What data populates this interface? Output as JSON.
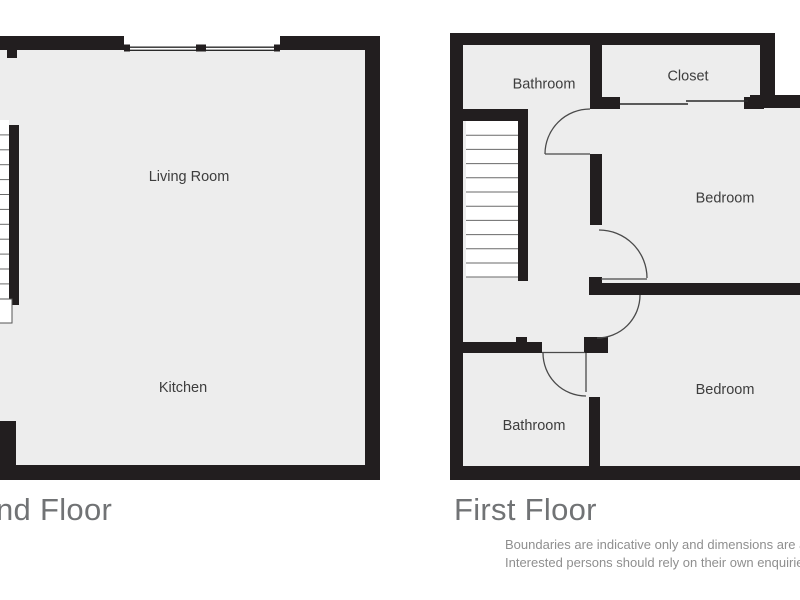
{
  "plans": [
    {
      "title": "nd Floor",
      "rooms": {
        "living": "Living Room",
        "kitchen": "Kitchen"
      }
    },
    {
      "title": "First Floor",
      "rooms": {
        "bathroom_top": "Bathroom",
        "closet": "Closet",
        "bedroom_top": "Bedroom",
        "bedroom_bottom": "Bedroom",
        "bathroom_bottom": "Bathroom"
      }
    }
  ],
  "disclaimer": {
    "line1": "Boundaries are indicative only and dimensions are ap",
    "line2": "Interested persons should rely on their own enquiries"
  },
  "colors": {
    "wall": "#221e1f",
    "floor": "#ededed",
    "room_label": "#3d3d3d",
    "title": "#717375",
    "disclaimer": "#8f8f8f",
    "background": "#ffffff"
  }
}
